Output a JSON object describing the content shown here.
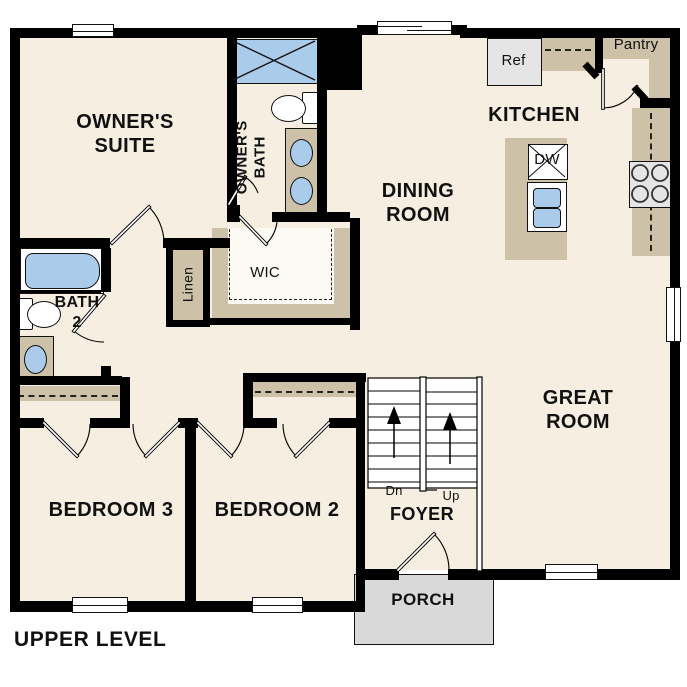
{
  "plan": {
    "title": "UPPER LEVEL",
    "rooms": {
      "owners_suite": "OWNER'S SUITE",
      "owners_bath": "OWNER'S BATH",
      "bath_2": "BATH 2",
      "wic": "WIC",
      "linen": "Linen",
      "dining_room": "DINING ROOM",
      "kitchen": "KITCHEN",
      "pantry": "Pantry",
      "great_room": "GREAT ROOM",
      "bedroom_3": "BEDROOM 3",
      "bedroom_2": "BEDROOM 2",
      "foyer": "FOYER",
      "porch": "PORCH"
    },
    "fixtures": {
      "refrigerator": "Ref",
      "dishwasher": "DW"
    },
    "stairs": {
      "down_label": "Dn",
      "up_label": "Up"
    },
    "colors": {
      "wall": "#000000",
      "floor": "#f5eee1",
      "cabinet": "#cdc1a8",
      "fixture": "#aacbea",
      "appliance": "#e5e5e5",
      "porch": "#d9d9d9"
    }
  }
}
